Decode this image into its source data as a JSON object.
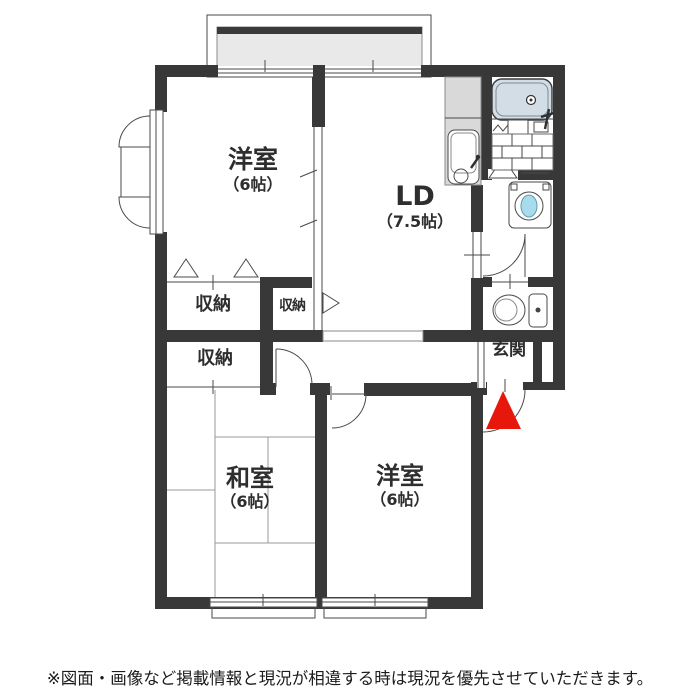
{
  "rooms": {
    "yoshitsu1": {
      "name": "洋室",
      "size": "（6帖）"
    },
    "ld": {
      "name": "LD",
      "size": "（7.5帖）"
    },
    "closet1": {
      "label": "収納"
    },
    "closet2": {
      "label": "収納"
    },
    "closet3": {
      "label": "収納"
    },
    "washitsu": {
      "name": "和室",
      "size": "（6帖）"
    },
    "yoshitsu2": {
      "name": "洋室",
      "size": "（6帖）"
    },
    "genkan": {
      "label": "玄関"
    }
  },
  "footer": {
    "disclaimer": "※図面・画像など掲載情報と現況が相違する時は現況を優先させていただきます。"
  },
  "colors": {
    "wall": "#383838",
    "balcony_floor": "#e9e9e9",
    "balcony_edge": "#3a3a3a",
    "kitchen_counter": "#d9d9d9",
    "bathtub": "#d3dde6",
    "laundry_water": "#a8dcec",
    "entrance_marker": "#e8170c"
  },
  "icons": [
    "casement-window-icon",
    "sliding-window-icon",
    "kitchen-sink-icon",
    "bathtub-icon",
    "bath-door-icon",
    "washing-machine-icon",
    "toilet-icon",
    "closet-door-icon",
    "room-door-icon",
    "entrance-door-icon",
    "entrance-marker-icon"
  ]
}
